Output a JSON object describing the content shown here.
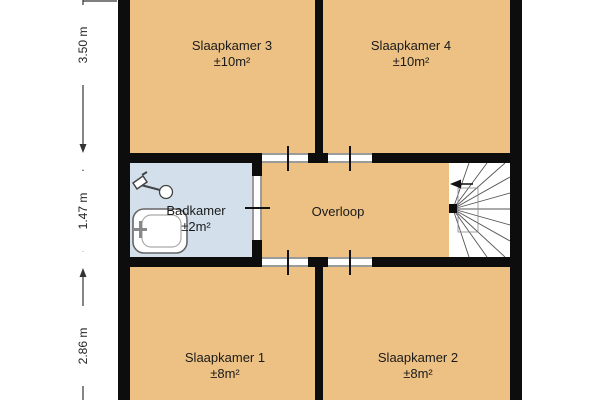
{
  "rooms": {
    "slaapkamer3": {
      "name": "Slaapkamer 3",
      "area": "±10m²"
    },
    "slaapkamer4": {
      "name": "Slaapkamer 4",
      "area": "±10m²"
    },
    "badkamer": {
      "name": "Badkamer",
      "area": "±2m²"
    },
    "overloop": {
      "name": "Overloop"
    },
    "slaapkamer1": {
      "name": "Slaapkamer 1",
      "area": "±8m²"
    },
    "slaapkamer2": {
      "name": "Slaapkamer 2",
      "area": "±8m²"
    }
  },
  "dimensions": {
    "top": "3.50 m",
    "middle": "1.47 m",
    "bottom": "2.86 m"
  },
  "icons": {
    "stairs": "winder-staircase-icon",
    "shower": "shower-head-icon",
    "sink": "washbasin-icon",
    "stair_direction": "stair-direction-arrow-icon"
  },
  "colors": {
    "room_fill": "#ecc183",
    "bathroom_fill": "#d3e0ec",
    "wall": "#0d0d0d",
    "stair_area": "#ffffff",
    "door_threshold": "#9b9b9b",
    "background": "#ffffff"
  }
}
